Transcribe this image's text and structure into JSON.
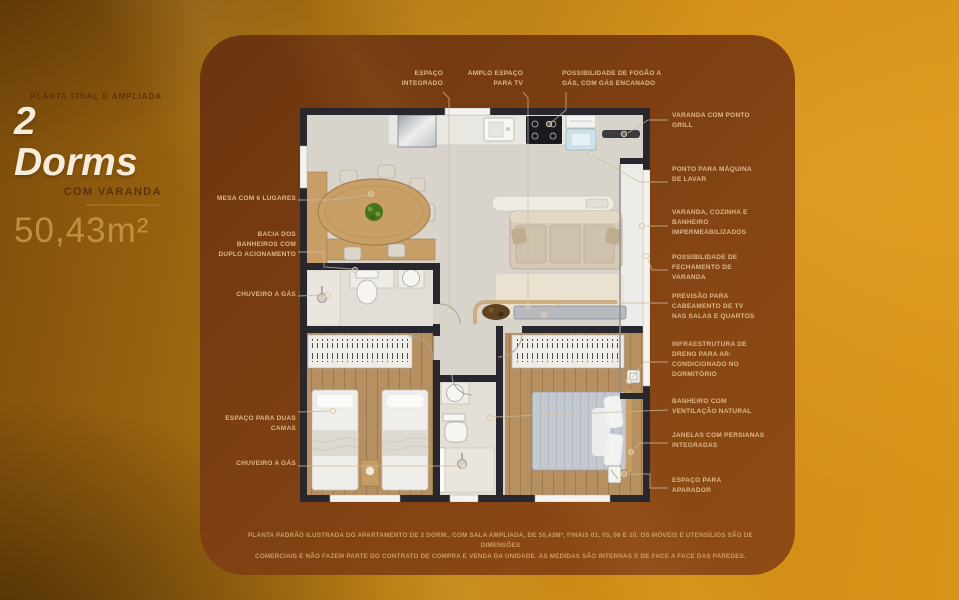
{
  "title_block": {
    "eyebrow": "PLANTA FINAL E AMPLIADA",
    "title": "2 Dorms",
    "subtitle": "COM VARANDA",
    "area": "50,43m²"
  },
  "callouts": {
    "top": [
      "ESPAÇO INTEGRADO",
      "AMPLO ESPAÇO PARA TV",
      "POSSIBILIDADE DE FOGÃO A GÁS, COM GÁS ENCANADO"
    ],
    "left": [
      "MESA COM 6 LUGARES",
      "BACIA DOS BANHEIROS COM DUPLO ACIONAMENTO",
      "CHUVEIRO A GÁS",
      "ESPAÇO PARA DUAS CAMAS",
      "CHUVEIRO A GÁS"
    ],
    "right": [
      "VARANDA COM PONTO GRILL",
      "PONTO PARA MÁQUINA DE LAVAR",
      "VARANDA, COZINHA E BANHEIRO IMPERMEABILIZADOS",
      "POSSIBILIDADE DE FECHAMENTO DE VARANDA",
      "PREVISÃO PARA CABEAMENTO DE TV NAS SALAS E QUARTOS",
      "INFRAESTRUTURA DE DRENO PARA AR-CONDICIONADO NO DORMITÓRIO",
      "BANHEIRO COM VENTILAÇÃO NATURAL",
      "JANELAS COM PERSIANAS INTEGRADAS",
      "ESPAÇO PARA APARADOR"
    ]
  },
  "disclaimer": {
    "line1": "PLANTA PADRÃO ILUSTRADA DO APARTAMENTO DE 2 DORM., COM SALA AMPLIADA, DE 50,43M², FINAIS 01, 05, 06 E 10. OS MÓVEIS E UTENSÍLIOS SÃO DE DIMENSÕES",
    "line2": "COMERCIAIS E NÃO FAZEM PARTE DO CONTRATO DE COMPRA E VENDA DA UNIDADE. AS MEDIDAS SÃO INTERNAS E DE FACE A FACE DAS PAREDES."
  },
  "colors": {
    "background_gold": "#d08c16",
    "panel_brown": "#7a3d12",
    "callout_text": "#ddb98a",
    "title_light": "#f6ecd9",
    "title_dark": "#5e3208",
    "area_tan": "#bf9040",
    "wall": "#27272d",
    "wood": "#b69060"
  }
}
